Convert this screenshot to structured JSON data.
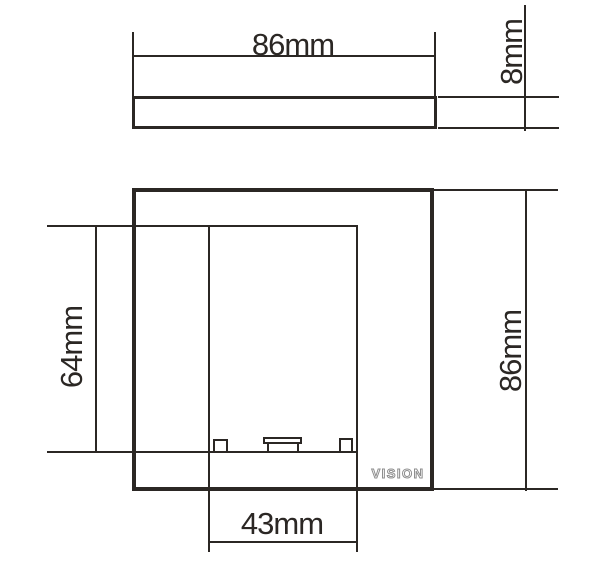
{
  "title": "Faceplate dimension drawing",
  "colors": {
    "line": "#2b2724",
    "background": "#ffffff",
    "logo_outline": "#8d8d8d"
  },
  "views": {
    "profile": {
      "width": "86mm",
      "thickness": "8mm"
    },
    "front": {
      "height": "86mm",
      "aperture_height": "64mm",
      "aperture_width": "43mm",
      "logo": "VISION"
    }
  }
}
